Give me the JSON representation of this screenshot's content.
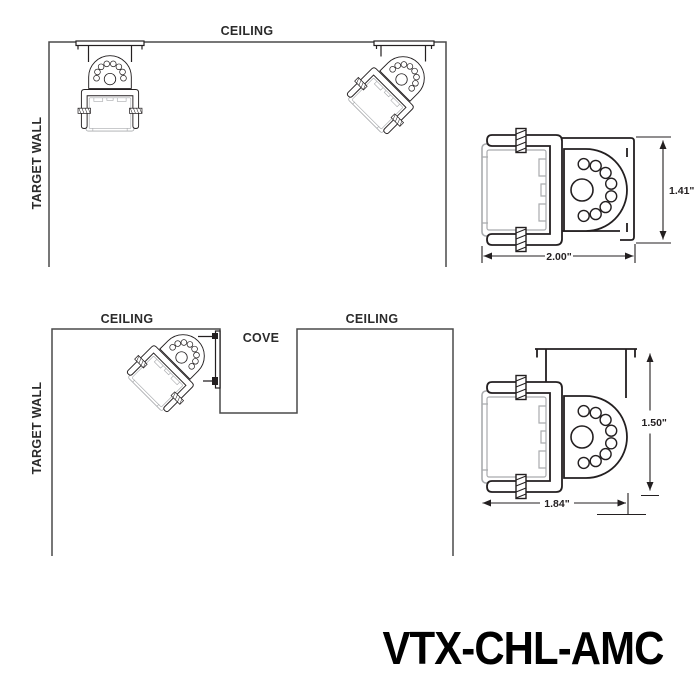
{
  "product_code": "VTX-CHL-AMC",
  "colors": {
    "line": "#231f20",
    "wall": "#4a4a4a",
    "extrusion": "#a9abae",
    "background": "#ffffff"
  },
  "ceiling_diagram": {
    "ceiling_label": "CEILING",
    "target_wall_label": "TARGET WALL"
  },
  "cove_diagram": {
    "ceiling_left_label": "CEILING",
    "cove_label": "COVE",
    "ceiling_right_label": "CEILING",
    "target_wall_label": "TARGET WALL"
  },
  "detail_flush_mount": {
    "height_dim": "1.41\"",
    "width_dim": "2.00\""
  },
  "detail_hat_mount": {
    "height_dim": "1.50\"",
    "width_dim": "1.84\""
  }
}
